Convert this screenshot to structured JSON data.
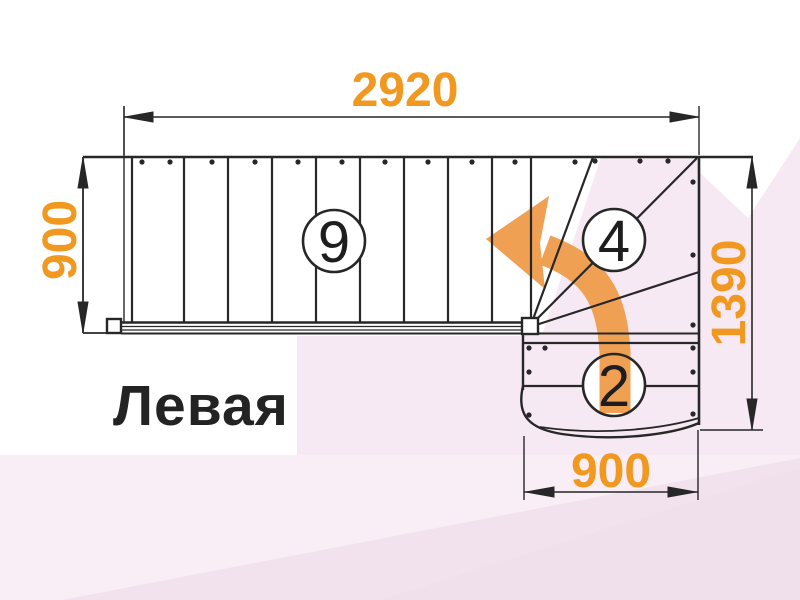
{
  "title_label": "Левая",
  "dimensions": {
    "top_width_mm": "2920",
    "left_height_mm": "900",
    "right_height_mm": "1390",
    "bottom_width_mm": "900"
  },
  "step_counts": {
    "straight_flight": "9",
    "winders": "4",
    "lower_flight": "2"
  },
  "icons": {
    "turn_arrow": "curved-left-turn-arrow"
  },
  "colors": {
    "dimension_text": "#f0981f",
    "turn_arrow": "#efa052",
    "drawing_lines": "#272727",
    "pink_main": "#f7e9f3",
    "pink_bottom_strip": "#f9eef6",
    "pink_bottom_diagonal": "#f2e2ee"
  }
}
